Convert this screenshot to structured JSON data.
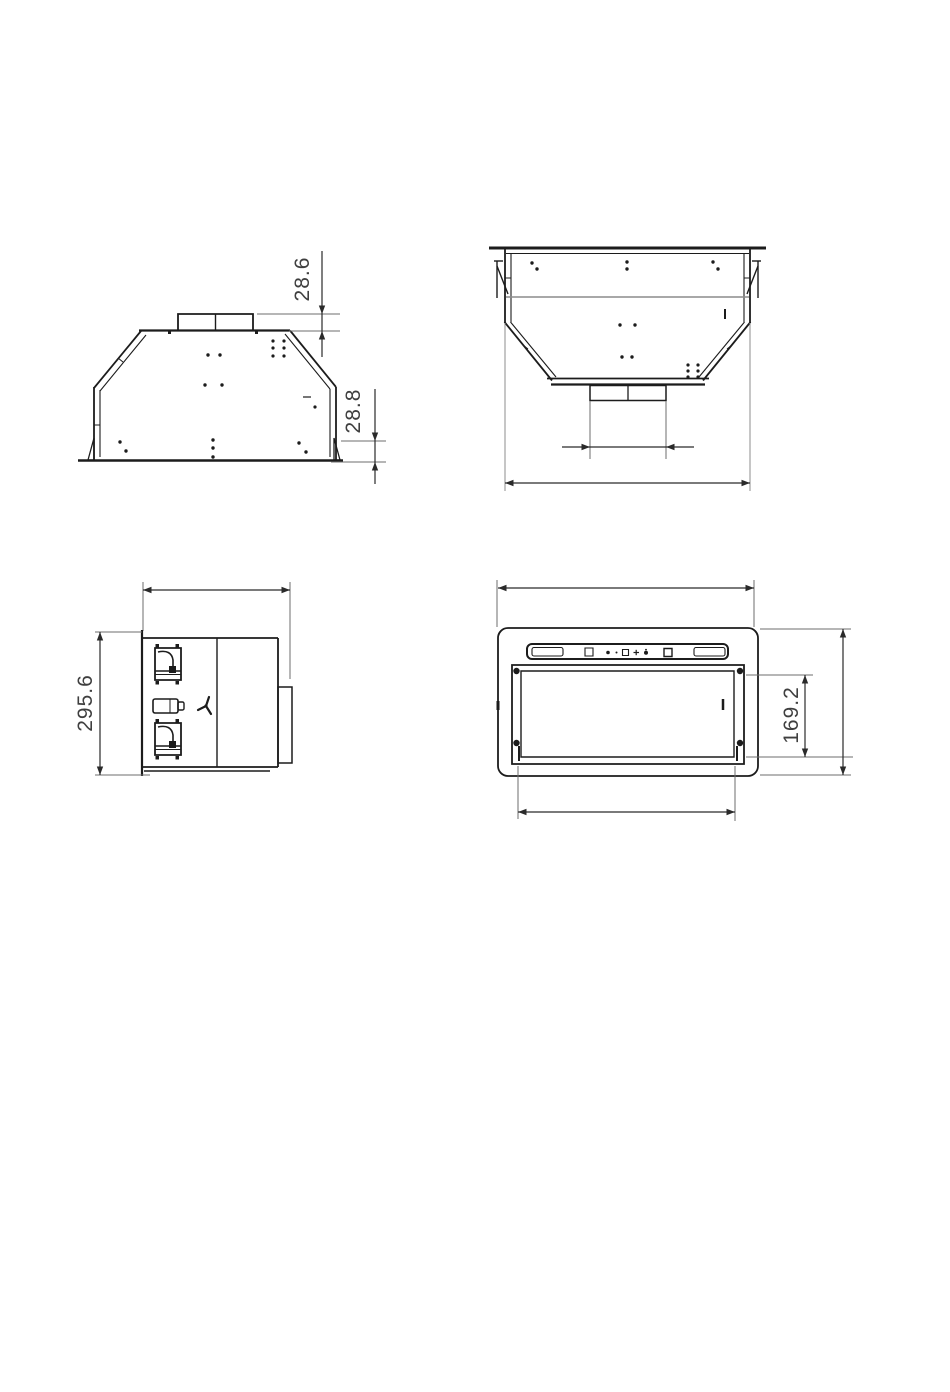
{
  "colors": {
    "background": "#ffffff",
    "line": "#1c1c1c",
    "extension_line": "#6e6e6e",
    "dimension_line": "#2a2a2a",
    "label_text": "#3f3f3f"
  },
  "views": {
    "side": {
      "label_duct_height": "28.6",
      "label_flange_height": "28.8"
    },
    "rear": {},
    "profile": {
      "label_height": "295.6"
    },
    "bottom": {
      "label_filter_height": "169.2"
    }
  }
}
